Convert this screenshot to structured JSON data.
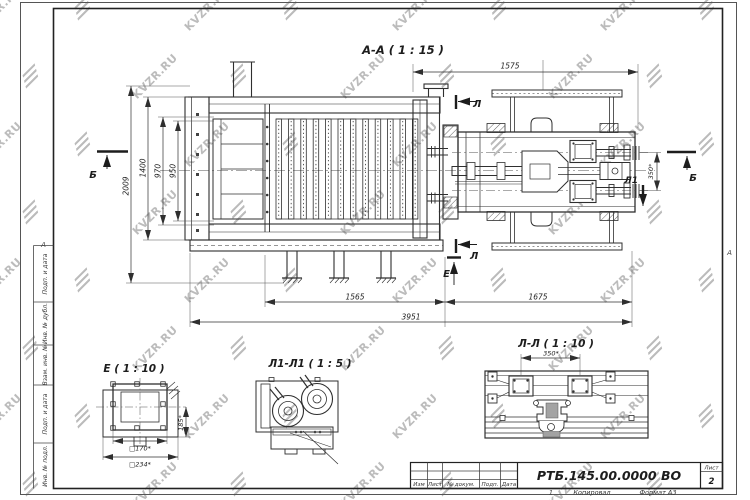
{
  "watermark": {
    "text": "KVZR.RU"
  },
  "sheet": {
    "zone_marker_left": "А",
    "zone_marker_right": "А",
    "stamp_labels": [
      "Подп. и дата",
      "Инв. № дубл.",
      "Взам. инв. №",
      "Подп. и дата",
      "Инв. № подл."
    ]
  },
  "title_block": {
    "columns": [
      "Изм",
      "Лист",
      "№ докум.",
      "Подп.",
      "Дата"
    ],
    "doc_number": "РТБ.145.00.0000 ВО",
    "sheet_label": "Лист",
    "sheet_number": "2",
    "footer_note": "1",
    "footer_copy": "Копировал",
    "footer_format": "Формат А3"
  },
  "main_view": {
    "title": "А-А ( 1 : 15 )",
    "dims": {
      "top": "1575",
      "overall_height": "2009",
      "body_height": "1400",
      "inner_height_1": "970",
      "inner_height_2": "950",
      "bottom_left": "1565",
      "bottom_right": "1675",
      "total_length": "3951",
      "spacing_350": "350*"
    },
    "markers": {
      "b_left": "Б",
      "b_right": "Б",
      "l_top": "Л",
      "l_bottom": "Л",
      "l1": "Л1",
      "e": "Е"
    }
  },
  "details": {
    "e": {
      "title": "Е ( 1 : 10 )",
      "dim_height": "185*",
      "dim_inner": "□170*",
      "dim_outer": "□234*"
    },
    "l1": {
      "title": "Л1-Л1 ( 1 : 5 )"
    },
    "ll": {
      "title": "Л-Л ( 1 : 10 )",
      "dim_width": "350*"
    }
  }
}
